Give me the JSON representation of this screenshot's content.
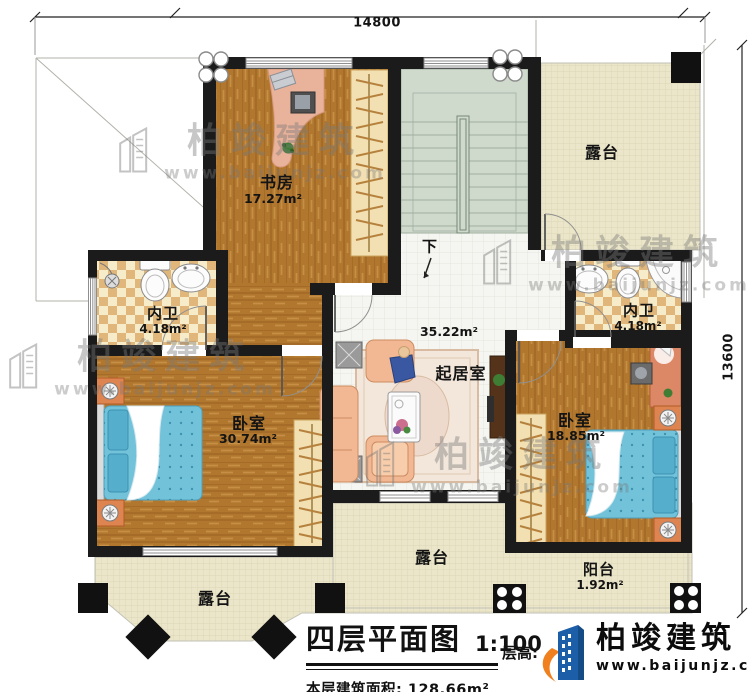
{
  "dimensions": {
    "top": "14800",
    "right": "13600"
  },
  "rooms": {
    "study": {
      "label": "书房",
      "area": "17.27m²"
    },
    "bath_left": {
      "label": "内卫",
      "area": "4.18m²"
    },
    "bath_right": {
      "label": "内卫",
      "area": "4.18m²"
    },
    "bedroom_left": {
      "label": "卧室",
      "area": "30.74m²"
    },
    "bedroom_right": {
      "label": "卧室",
      "area": "18.85m²"
    },
    "living": {
      "label": "起居室",
      "area": "35.22m²"
    },
    "terrace_top_right": {
      "label": "露台"
    },
    "terrace_bottom_center": {
      "label": "露台"
    },
    "terrace_bottom_left": {
      "label": "露台"
    },
    "balcony": {
      "label": "阳台",
      "area": "1.92m²"
    },
    "stairs": {
      "down_label": "下"
    }
  },
  "title_block": {
    "title": "四层平面图",
    "scale": "1:100",
    "floor_area_label": "本层建筑面积:",
    "floor_area_value": "128.66m²",
    "floor_height_label": "层高:"
  },
  "logo": {
    "brand": "柏竣建筑",
    "url": "www.baijunjz.com"
  },
  "watermark": {
    "brand": "柏竣建筑",
    "url": "www.baijunjz.com"
  },
  "colors": {
    "wall": "#1b1b1b",
    "wood": "#b1772e",
    "terrace": "#ebe6c9",
    "tile": "#f5f6f1",
    "stairs": "#cfdacd",
    "checker": "#e0b67b",
    "bed_blue": "#72c3da",
    "nightstand_orange": "#dd8450",
    "logo_blue": "#1c5fa8",
    "logo_orange": "#f07f1e"
  }
}
